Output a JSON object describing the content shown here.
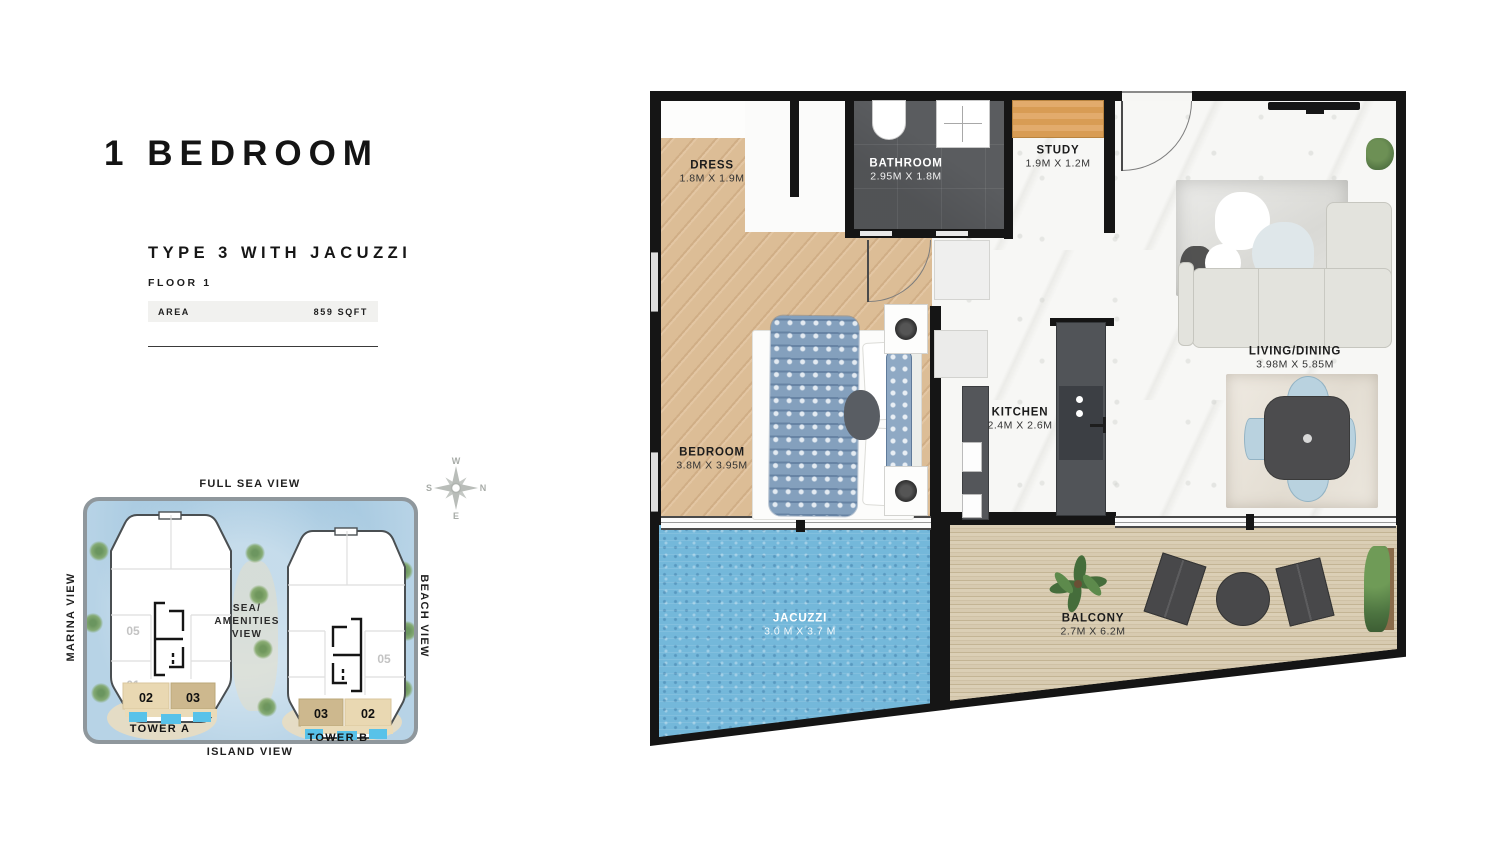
{
  "panel": {
    "title": "1 BEDROOM",
    "subtitle": "TYPE 3 WITH JACUZZI",
    "floor": "FLOOR 1",
    "area_label": "AREA",
    "area_value": "859 SQFT"
  },
  "floor_plan": {
    "rooms": [
      {
        "name": "DRESS",
        "dims": "1.8M X 1.9M"
      },
      {
        "name": "BATHROOM",
        "dims": "2.95M X 1.8M"
      },
      {
        "name": "STUDY",
        "dims": "1.9M X 1.2M"
      },
      {
        "name": "BEDROOM",
        "dims": "3.8M X 3.95M"
      },
      {
        "name": "KITCHEN",
        "dims": "2.4M X 2.6M"
      },
      {
        "name": "LIVING/DINING",
        "dims": "3.98M X 5.85M"
      },
      {
        "name": "JACUZZI",
        "dims": "3.0 M X 3.7 M"
      },
      {
        "name": "BALCONY",
        "dims": "2.7M X 6.2M"
      }
    ]
  },
  "site_map": {
    "views": {
      "top": "FULL SEA VIEW",
      "left": "MARINA VIEW",
      "right": "BEACH VIEW",
      "bottom": "ISLAND VIEW",
      "center_line1": "SEA/",
      "center_line2": "AMENITIES",
      "center_line3": "VIEW"
    },
    "tower_a": {
      "name": "TOWER A",
      "unit_05": "05",
      "unit_01": "01",
      "unit_04": "04",
      "unit_02": "02",
      "unit_03": "03"
    },
    "tower_b": {
      "name": "TOWER B",
      "unit_04": "04",
      "unit_05": "05",
      "unit_01": "01",
      "unit_03": "03",
      "unit_02": "02"
    },
    "compass": {
      "n": "N",
      "e": "E",
      "s": "S",
      "w": "W"
    }
  },
  "colors": {
    "wall": "#151515",
    "water": "#74b8da",
    "wood": "#dcbd97",
    "dark_tile": "#5a5c5f",
    "deck": "#d5c8ae",
    "map_water": "#b7d3e6",
    "unit_highlight_light": "#e9d8b2",
    "unit_highlight_dark": "#cdb88e",
    "pool_blue": "#58c2e9"
  }
}
